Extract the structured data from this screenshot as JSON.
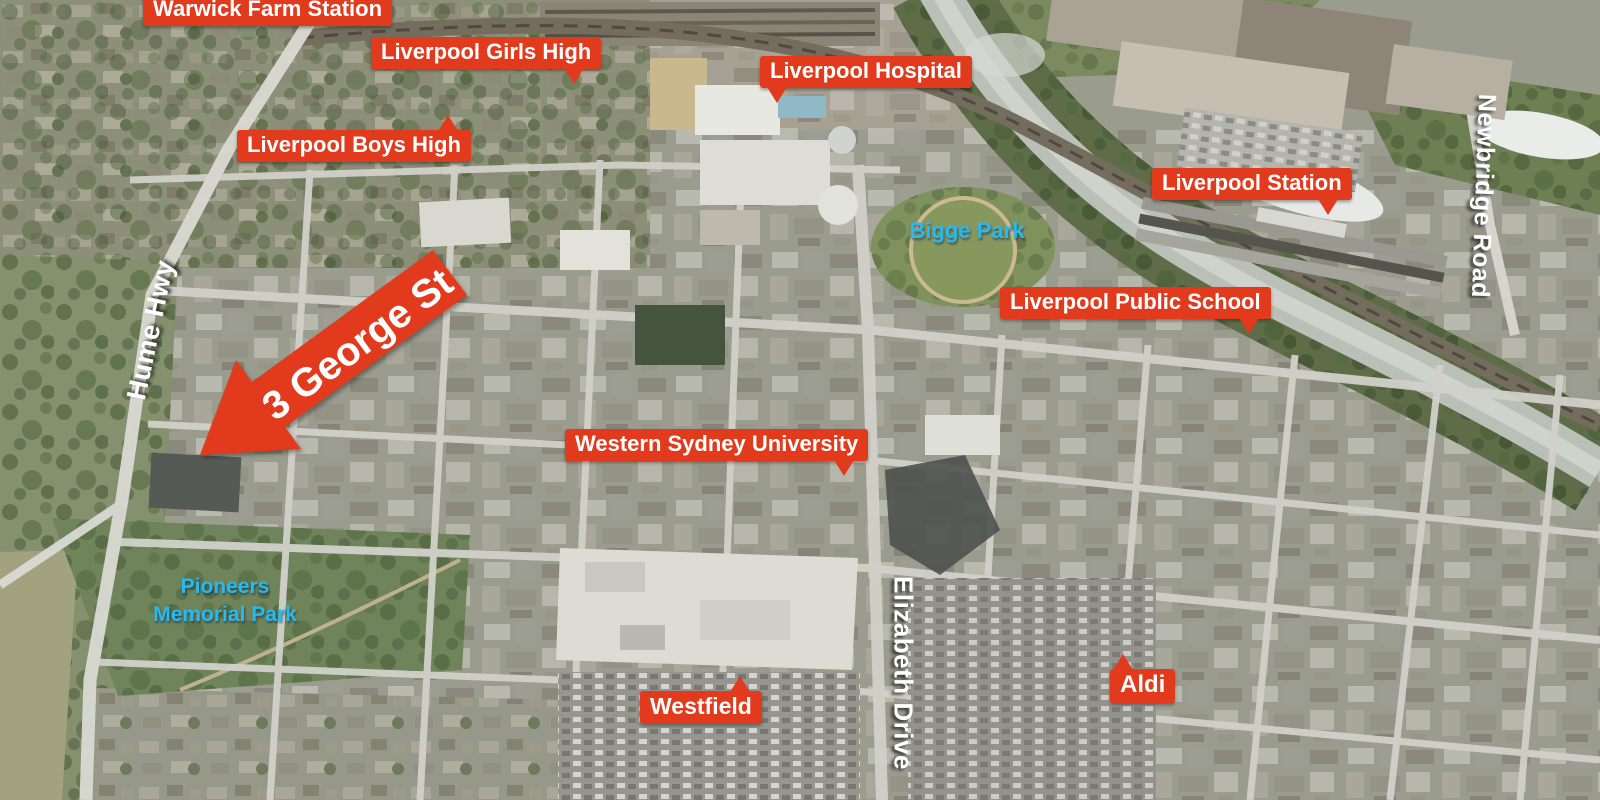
{
  "map": {
    "colors": {
      "label_red": "#e23a1d",
      "label_text": "#ffffff",
      "park_cyan": "#29b9ec",
      "road_white": "#ffffff"
    },
    "arrow": {
      "text": "3 George St"
    },
    "labels": [
      {
        "id": "warwick-farm-station",
        "type": "poi",
        "text": "Warwick Farm Station",
        "x": 143,
        "y": -6
      },
      {
        "id": "liverpool-girls-high",
        "type": "poi",
        "text": "Liverpool Girls High",
        "x": 371,
        "y": 37,
        "tail": {
          "side": "bottom",
          "at": 0.88
        }
      },
      {
        "id": "liverpool-boys-high",
        "type": "poi",
        "text": "Liverpool Boys High",
        "x": 237,
        "y": 130,
        "tail": {
          "side": "top",
          "at": 0.9
        }
      },
      {
        "id": "liverpool-hospital",
        "type": "poi",
        "text": "Liverpool Hospital",
        "x": 760,
        "y": 56,
        "tail": {
          "side": "bottom",
          "at": 0.08
        }
      },
      {
        "id": "liverpool-station",
        "type": "poi",
        "text": "Liverpool Station",
        "x": 1152,
        "y": 168,
        "tail": {
          "side": "bottom",
          "at": 0.88
        }
      },
      {
        "id": "liverpool-public-school",
        "type": "poi",
        "text": "Liverpool Public School",
        "x": 1000,
        "y": 287,
        "tail": {
          "side": "bottom",
          "at": 0.92
        }
      },
      {
        "id": "western-sydney-university",
        "type": "poi",
        "text": "Western Sydney University",
        "x": 565,
        "y": 429,
        "tail": {
          "side": "bottom",
          "at": 0.92
        }
      },
      {
        "id": "westfield",
        "type": "poi",
        "text": "Westfield",
        "x": 640,
        "y": 691,
        "fs": 23,
        "tail": {
          "side": "top",
          "at": 0.82
        }
      },
      {
        "id": "aldi",
        "type": "poi",
        "text": "Aldi",
        "x": 1110,
        "y": 669,
        "fs": 24,
        "tail": {
          "side": "top",
          "at": 0.2
        }
      },
      {
        "id": "bigge-park",
        "type": "park",
        "text": "Bigge Park",
        "x": 967,
        "y": 231
      },
      {
        "id": "pioneers-memorial-park",
        "type": "park",
        "lines": [
          "Pioneers",
          "Memorial Park"
        ],
        "x": 225,
        "y": 601,
        "fs": 21
      },
      {
        "id": "hume-hwy",
        "type": "road",
        "text": "Hume Hwy",
        "x": 151,
        "y": 330,
        "rotate": -78,
        "fs": 27
      },
      {
        "id": "elizabeth-drive",
        "type": "road",
        "text": "Elizabeth Drive",
        "x": 903,
        "y": 673,
        "rotate": 90
      },
      {
        "id": "newbridge-road",
        "type": "road",
        "text": "Newbridge Road",
        "x": 1483,
        "y": 196,
        "rotate": 92,
        "fs": 25
      }
    ]
  }
}
